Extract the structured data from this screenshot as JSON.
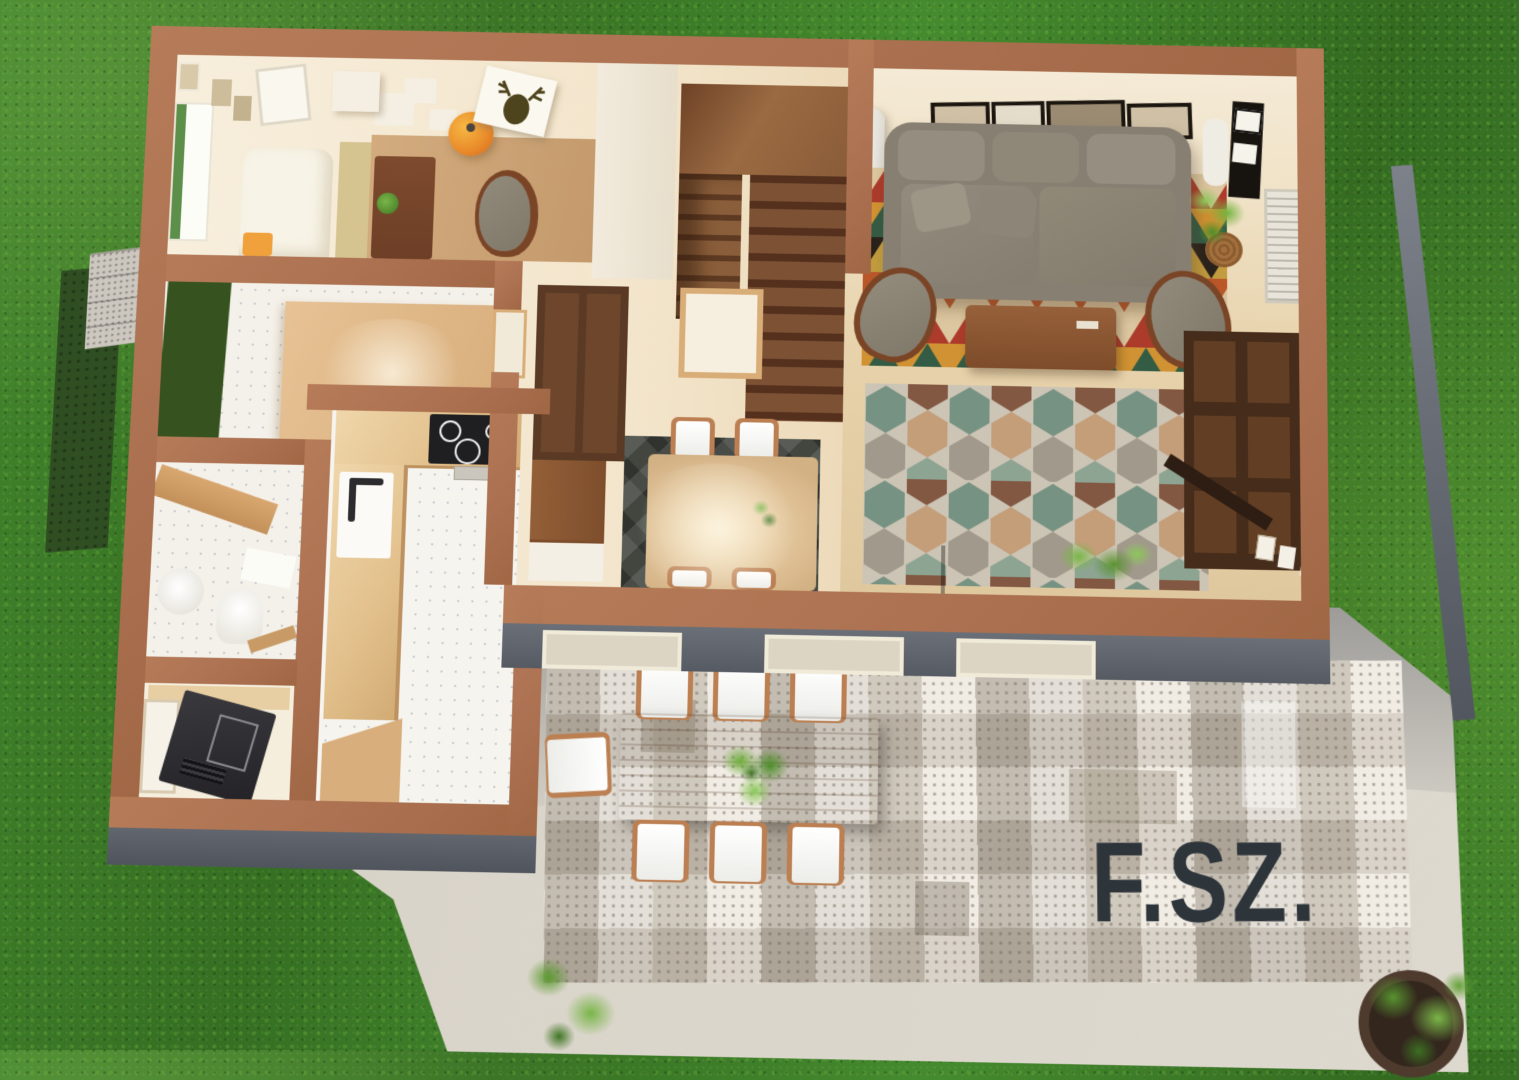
{
  "scene": {
    "title": "3D ground-floor plan render",
    "floor_label": "F.SZ.",
    "environment": {
      "ground": "grass lawn",
      "patio": "concrete slab",
      "entry": "gravel steps",
      "hedge": "green hedge strip"
    },
    "colors": {
      "wall_top": "#ac7151",
      "wall_side": "#575c66",
      "grass": "#3c7a27",
      "slab": "#d8d3c8",
      "floor_cream": "#f6ecd9",
      "wood_light": "#ddbe93",
      "wood_dark": "#5a3a24",
      "sofa_gray": "#8b8477",
      "label_text": "#2d343a",
      "pendant_orange": "#e98a2a"
    },
    "rooms": [
      {
        "name": "study",
        "furniture": [
          "daybed",
          "yellow-cushion",
          "desk",
          "desk-plant",
          "desk-chair",
          "orange-pendant-lamp",
          "deer-art-canvas",
          "wall-box-shelves",
          "wall-pictures",
          "window"
        ]
      },
      {
        "name": "stair-hall",
        "furniture": [
          "wood-staircase",
          "landing",
          "door-frame"
        ]
      },
      {
        "name": "entry-hall",
        "furniture": [
          "green-doormat",
          "wood-platform",
          "wall-pictures",
          "tile-floor"
        ]
      },
      {
        "name": "bathroom",
        "furniture": [
          "wood-shelf",
          "pedestal-sink",
          "toilet",
          "bath-mat"
        ]
      },
      {
        "name": "utility-room",
        "furniture": [
          "black-refrigerator",
          "wood-counter",
          "white-door"
        ]
      },
      {
        "name": "kitchen",
        "furniture": [
          "cooktop",
          "sink-with-faucet",
          "beech-counters",
          "tile-floor"
        ]
      },
      {
        "name": "dining-area",
        "furniture": [
          "dining-table",
          "dining-chairs",
          "dark-area-rug",
          "tall-cabinet",
          "low-cabinet"
        ]
      },
      {
        "name": "living-room",
        "furniture": [
          "gray-sofa",
          "triangle-pattern-rug",
          "hexagon-pattern-rug",
          "coffee-table",
          "armchair-left",
          "armchair-right",
          "floor-lamp",
          "radiator-column",
          "tv-panel",
          "gallery-frames",
          "bookcase",
          "sideboard",
          "potted-plants",
          "window"
        ]
      },
      {
        "name": "terrace",
        "furniture": [
          "patterned-tile-rug",
          "outdoor-dining-table",
          "seven-white-chairs",
          "table-plant",
          "potted-plants"
        ]
      }
    ]
  }
}
